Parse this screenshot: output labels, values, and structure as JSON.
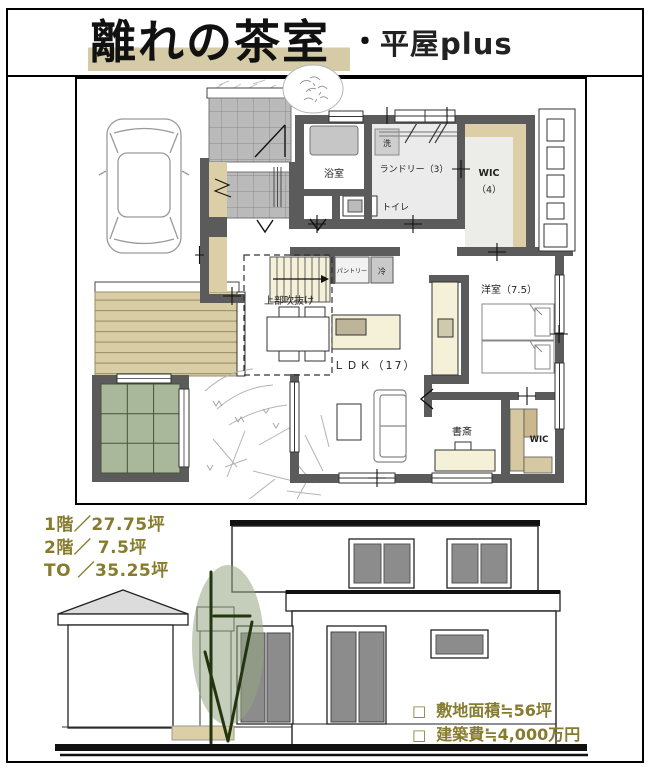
{
  "title": {
    "main": "離れの茶室",
    "separator": "・",
    "sub": "平屋plus"
  },
  "plan": {
    "labels": {
      "bath": "浴室",
      "washer": "洗",
      "laundry": "ランドリー（3）",
      "wic_upper": "WIC",
      "wic_upper_size": "（4）",
      "toilet": "トイレ",
      "void_above": "上部吹抜け",
      "pantry": "パントリー",
      "fridge": "冷",
      "ldk": "ＬＤＫ（17）",
      "bedroom": "洋室（7.5）",
      "study": "書斎",
      "wic_lower": "WIC"
    }
  },
  "stats": {
    "floor1": "1階／27.75坪",
    "floor2": "2階／ 7.5坪",
    "total": "TO ／35.25坪"
  },
  "notes": [
    {
      "bullet": "□",
      "label": "敷地面積≒56坪"
    },
    {
      "bullet": "□",
      "label": "建築費≒4,000万円"
    }
  ],
  "colors": {
    "accent_olive": "#877c2e",
    "title_highlight": "#d5cba6",
    "wall_gray": "#5b5b5b",
    "closet_tan": "#dccfa8",
    "floor_cream": "#f4f1d8",
    "tatami_green": "#a9b89b",
    "tile_gray": "#bababa",
    "fixture_gray": "#8c8c8c"
  }
}
